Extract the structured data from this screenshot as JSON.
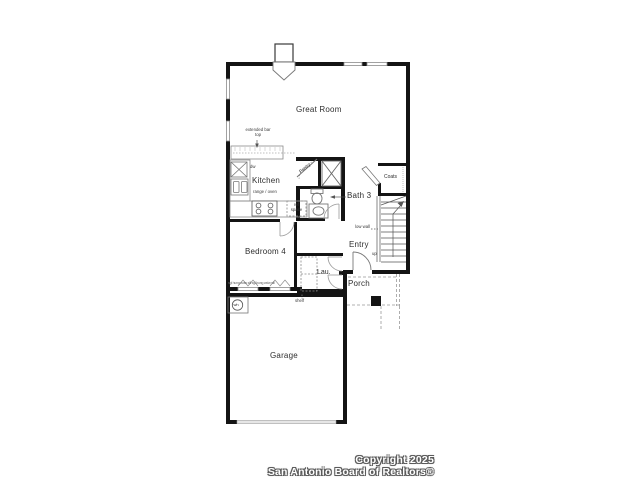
{
  "rooms": {
    "great_room": "Great Room",
    "kitchen": "Kitchen",
    "bath_3": "Bath 3",
    "bedroom_4": "Bedroom 4",
    "entry": "Entry",
    "laundry": "Lau.",
    "porch": "Porch",
    "garage": "Garage",
    "coats": "Coats",
    "pantry": "Pantry"
  },
  "annotations": {
    "extended_bar_top": "extended bar top",
    "range_oven": "range / oven",
    "ref_space": "ref space",
    "dishwasher": "dw",
    "low_wall": "low wall",
    "stairs_up": "up",
    "shelf": "shelf",
    "water_heater": "wh",
    "window_note": "sgl hung wdw sill  sgl hung wdw sill"
  },
  "watermark": {
    "line1": "Copyright 2025",
    "line2": "San Antonio Board of Realtors®"
  },
  "colors": {
    "wall": "#141414",
    "thin_line": "#8a8a8a",
    "text": "#2e2e2e",
    "background": "#ffffff"
  }
}
